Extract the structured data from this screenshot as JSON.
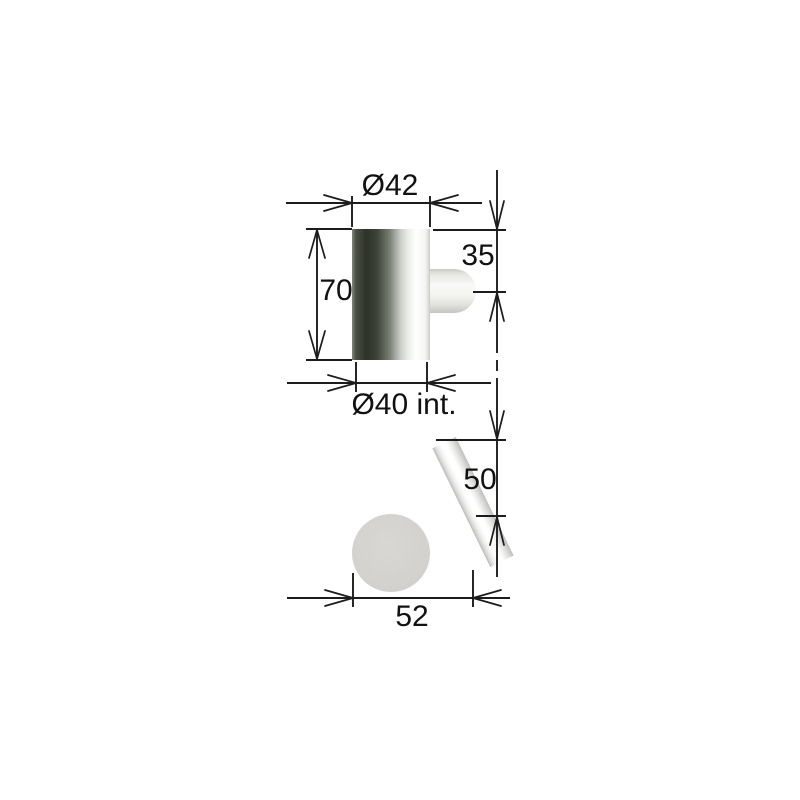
{
  "drawing": {
    "kind": "technical-dimension-drawing",
    "labels": {
      "outer_diameter": "Ø42",
      "body_height": "70",
      "pin_offset": "35",
      "inner_diameter": "Ø40 int.",
      "drop_height": "50",
      "base_width": "52"
    },
    "dimensions": [
      {
        "name": "outer-diameter",
        "label": "Ø42",
        "value": 42,
        "orientation": "horizontal",
        "view": "top"
      },
      {
        "name": "body-height",
        "label": "70",
        "value": 70,
        "orientation": "vertical",
        "view": "top"
      },
      {
        "name": "pin-center-offset",
        "label": "35",
        "value": 35,
        "orientation": "vertical",
        "view": "top"
      },
      {
        "name": "inner-diameter",
        "label": "Ø40 int.",
        "value": 40,
        "orientation": "horizontal",
        "view": "top"
      },
      {
        "name": "drop-height",
        "label": "50",
        "value": 50,
        "orientation": "vertical",
        "view": "bottom"
      },
      {
        "name": "base-width",
        "label": "52",
        "value": 52,
        "orientation": "horizontal",
        "view": "bottom"
      }
    ],
    "colors": {
      "line": "#1c1c1c",
      "text": "#111111",
      "metal_dark": "#2d3227",
      "metal_mid": "#c9ccc5",
      "metal_light": "#ffffff",
      "edge_gray": "#c6c6c4",
      "disc_gray": "#d2d1ce",
      "background": "#ffffff"
    }
  }
}
